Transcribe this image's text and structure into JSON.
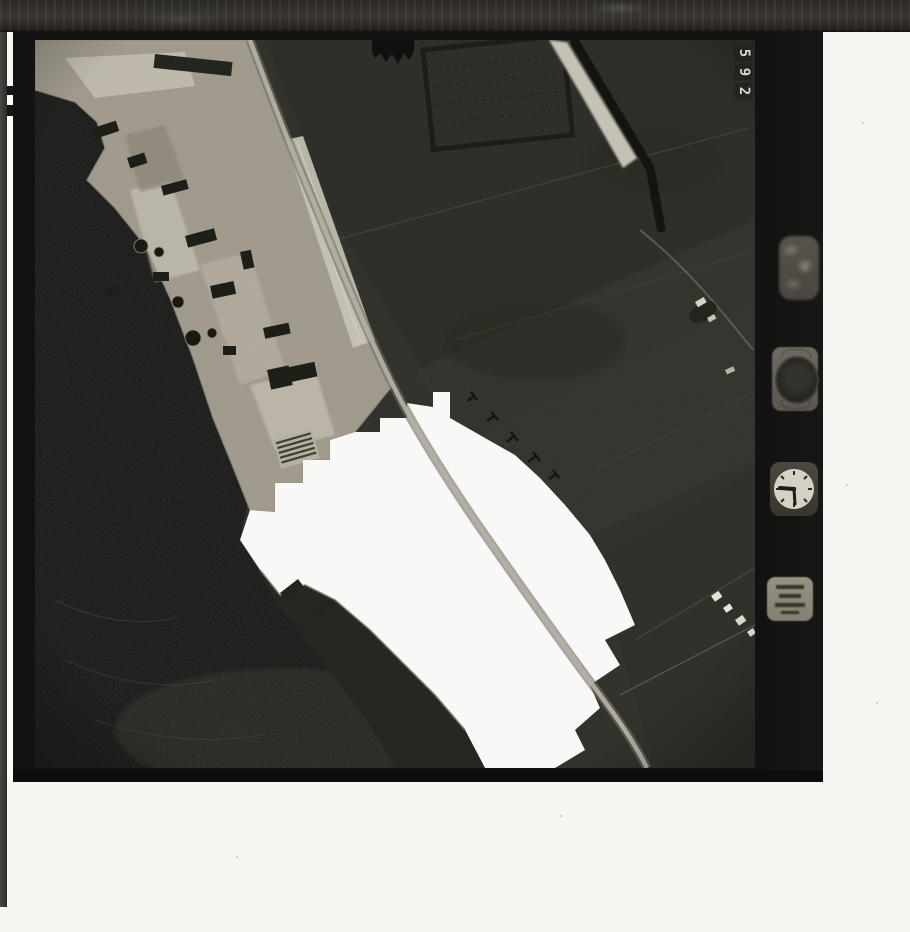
{
  "film": {
    "frame_number": "592",
    "frame_digits": [
      "5",
      "9",
      "2"
    ]
  },
  "right_margin_instruments": [
    "level-bubble",
    "altimeter-dial",
    "clock",
    "data-plate"
  ],
  "colors": {
    "scanner_background": "#f6f5f2",
    "film_black": "#121211",
    "leader_band": "#302d2a",
    "farmland_dark": "#2e2f29",
    "water_dark": "#151613",
    "industrial_light": "#a39d8f",
    "overexposed_white": "#fafaf8",
    "road_light": "#b4afa3",
    "clock_face": "#d5d1c5",
    "frame_digit_color": "#dbd8cf"
  }
}
